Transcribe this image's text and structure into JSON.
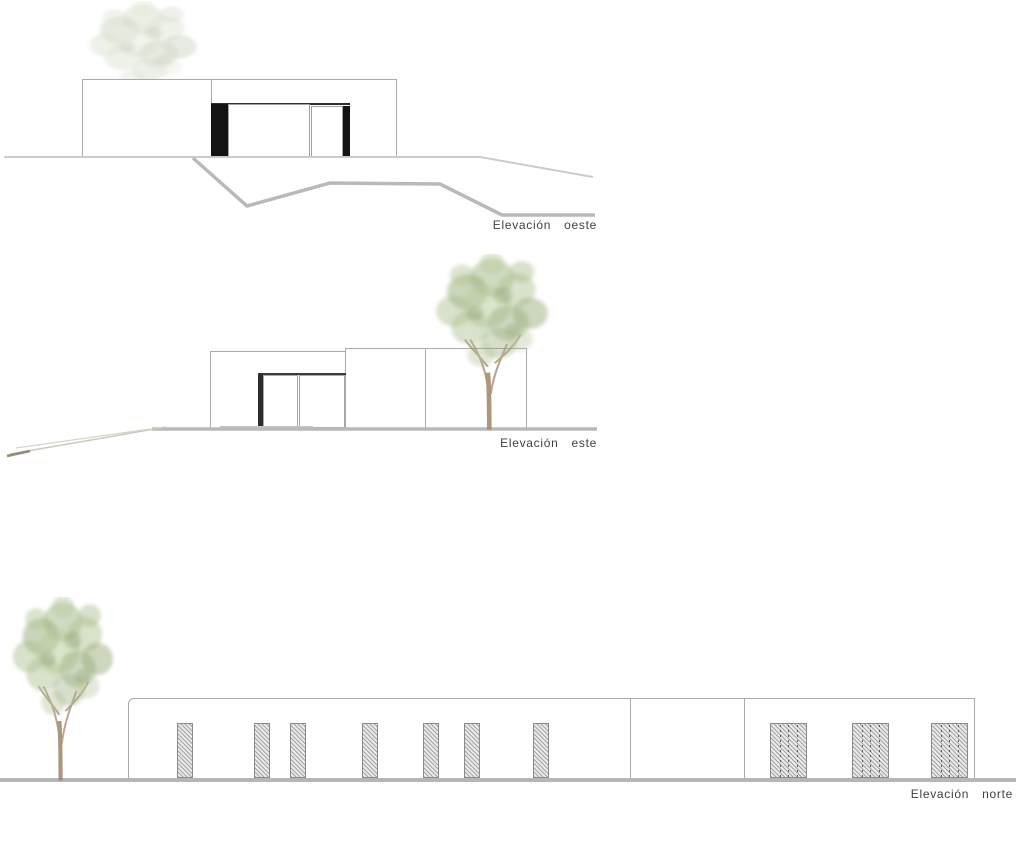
{
  "sheet": {
    "background": "#ffffff",
    "palette": {
      "outline_gray": "#a9a9a9",
      "ground_gray": "#b9b9b9",
      "window_black": "#141414",
      "hatch_gray": "#8a8a8a",
      "tree_green": "#93a877",
      "trunk_brown": "#a08a6a",
      "label_color": "#3f3f3f"
    }
  },
  "elevations": {
    "west": {
      "label": "Elevación oeste"
    },
    "east": {
      "label": "Elevación este"
    },
    "north": {
      "label": "Elevación norte",
      "openings": {
        "small_x": [
          177,
          254,
          290,
          362,
          423,
          464,
          533
        ],
        "wide_x": [
          770,
          852,
          931
        ]
      }
    }
  }
}
